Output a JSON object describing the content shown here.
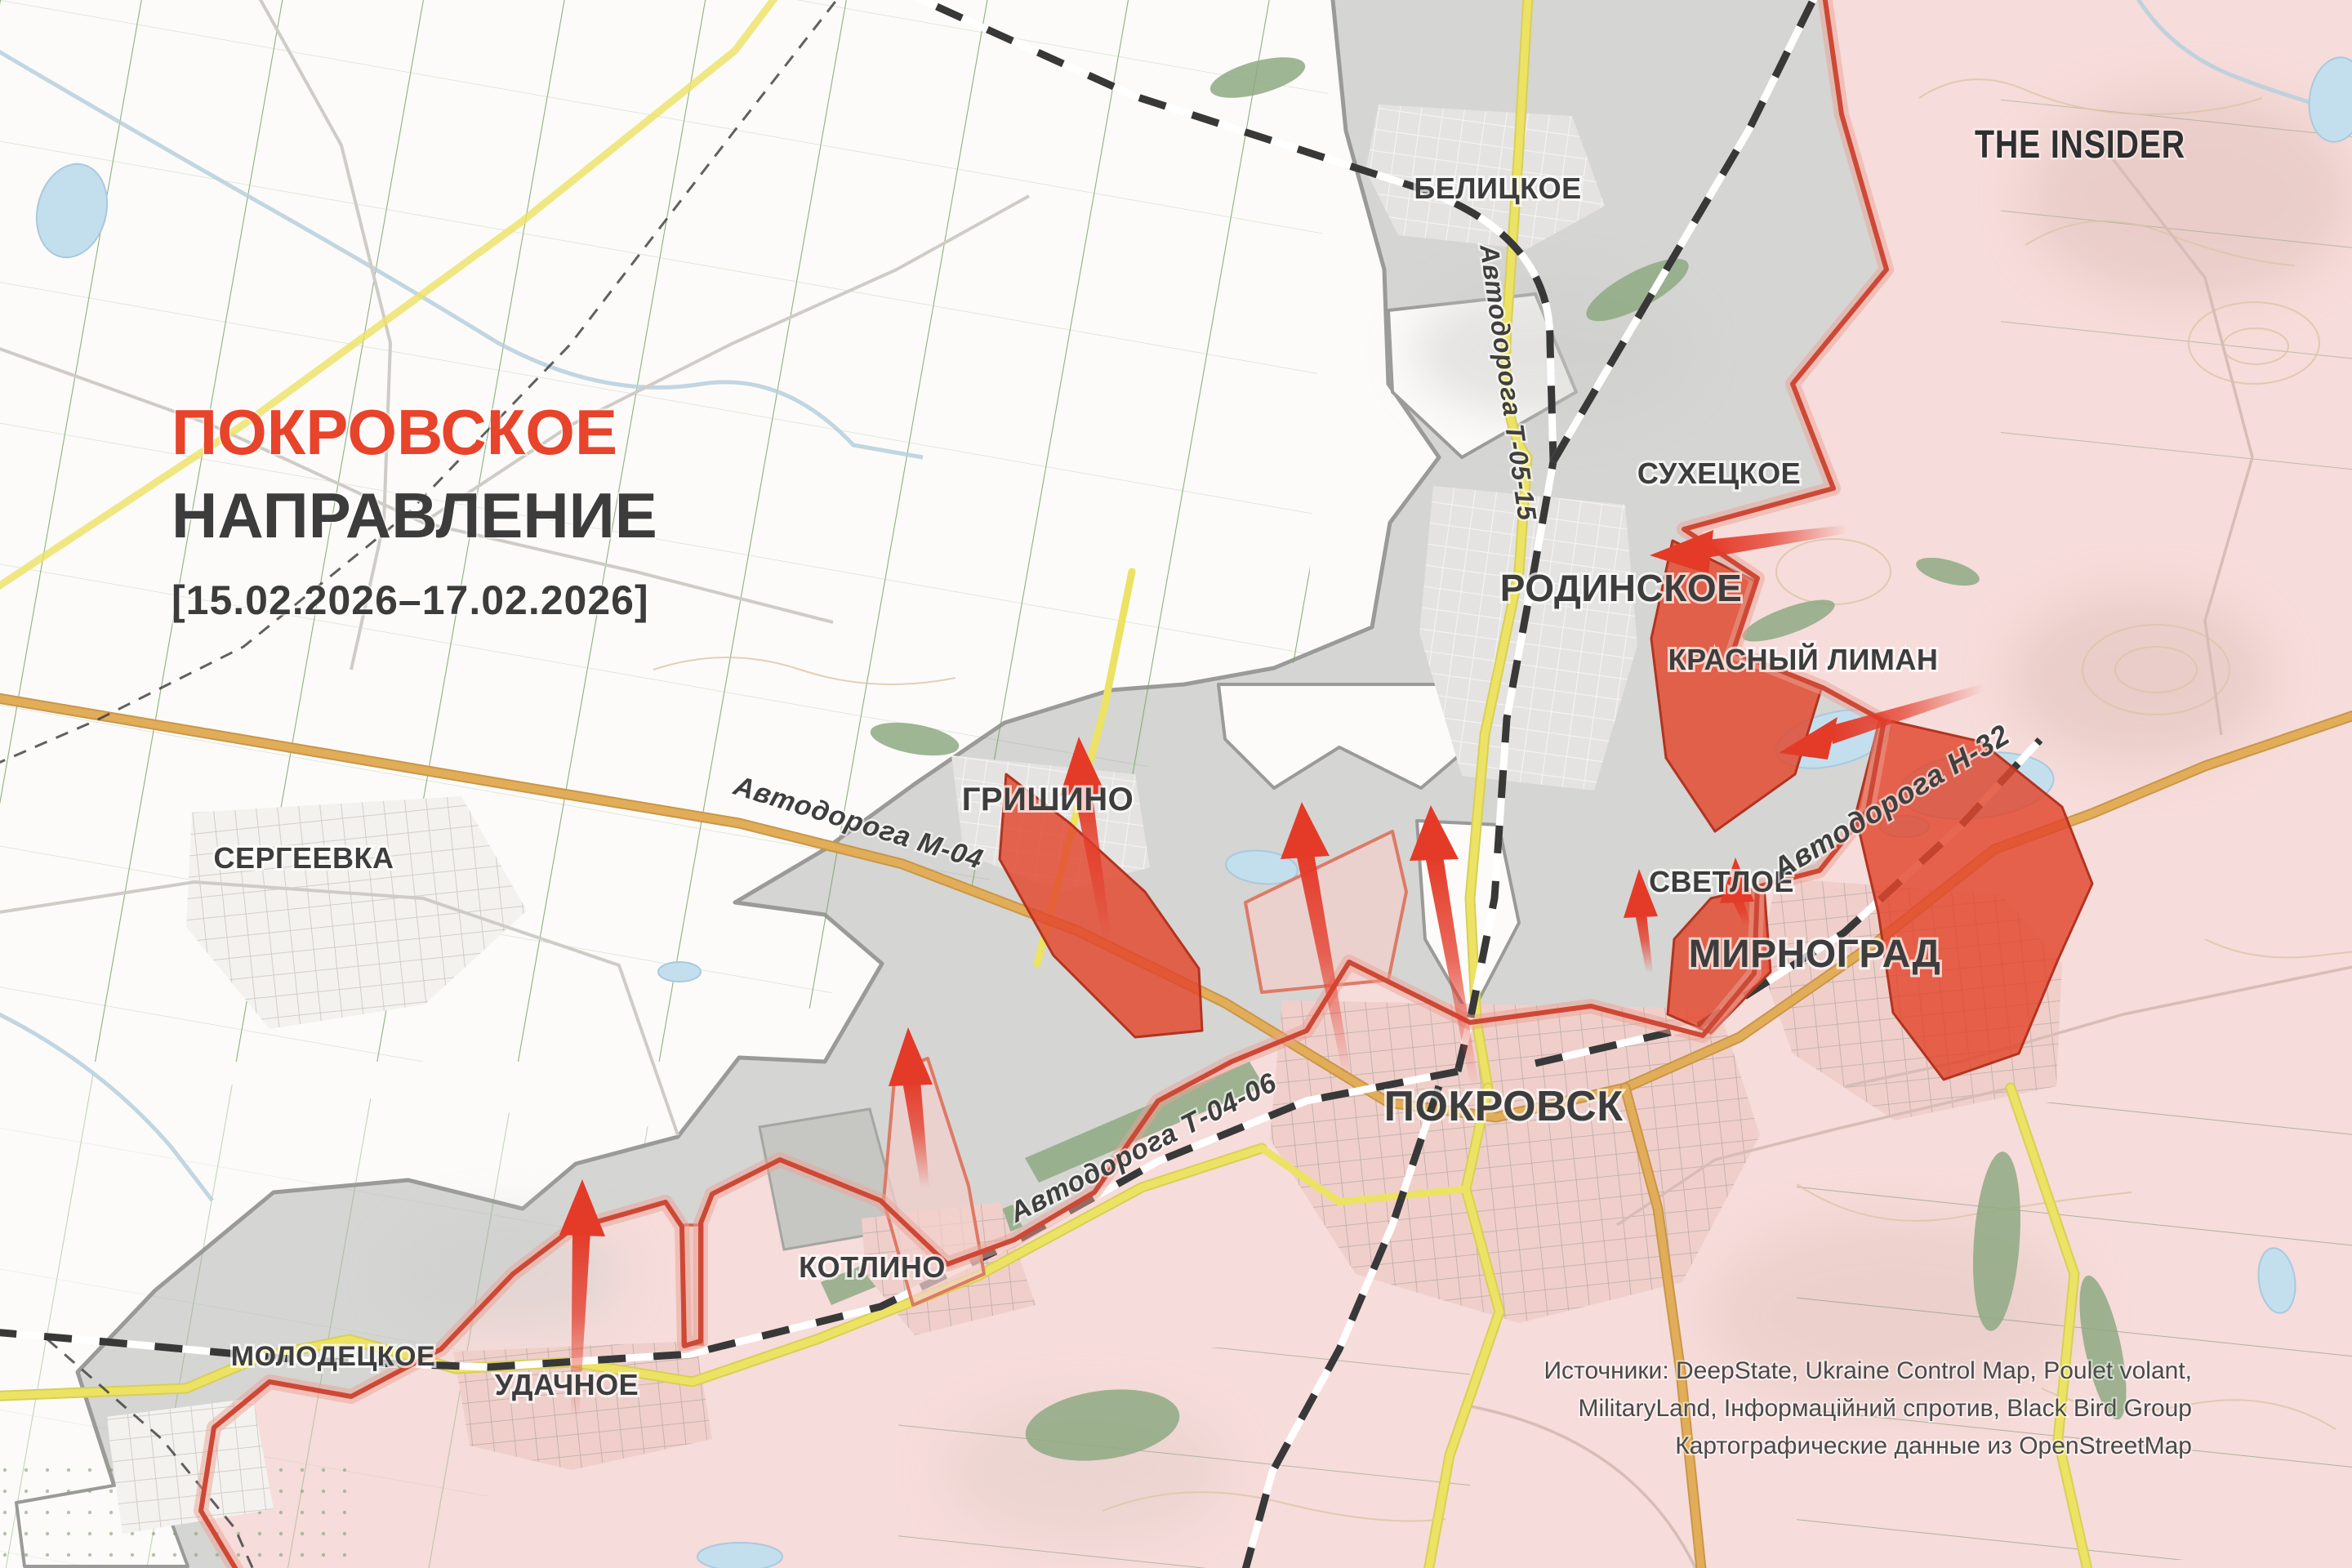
{
  "title": {
    "line1": "ПОКРОВСКОЕ",
    "line2": "НАПРАВЛЕНИЕ",
    "date_range": "[15.02.2026–17.02.2026]"
  },
  "brand": {
    "name": "THE INSIDER"
  },
  "settlements": {
    "belitskoe": "БЕЛИЦКОЕ",
    "sukhetskoe": "СУХЕЦКОЕ",
    "rodinskoe": "РОДИНСКОЕ",
    "krasny_liman": "КРАСНЫЙ ЛИМАН",
    "grishino": "ГРИШИНО",
    "sergeevka": "СЕРГЕЕВКА",
    "svetloe": "СВЕТЛОЕ",
    "mirnograd": "МИРНОГРАД",
    "pokrovsk": "ПОКРОВСК",
    "kotlino": "КОТЛИНО",
    "molodetskoe": "МОЛОДЕЦКОЕ",
    "udachnoe": "УДАЧНОЕ"
  },
  "roads": {
    "t0515": "Автодорога Т-05-15",
    "m04": "Автодорога М-04",
    "h32": "Автодорога Н-32",
    "t0406": "Автодорога Т-04-06"
  },
  "sources": {
    "line1": "Источники: DeepState, Ukraine Control Map, Poulet volant,",
    "line2": "MilitaryLand, Інформаційний спротив, Black Bird Group",
    "line3": "Картографические данные из OpenStreetMap"
  },
  "colors": {
    "title_red": "#e8432b",
    "title_dark": "#3c3c3c",
    "ua_area": "#fcfbf9",
    "contested_gray": "#d5d5d3",
    "contested_border": "#9a9a98",
    "ru_area": "#f6dcda",
    "advance_red": "#e2462c",
    "advance_border": "#b23420",
    "frontline_red": "#ce4836",
    "arrow_red": "#e43a28",
    "road_yellow": "#ece264",
    "road_tan": "#e1ad58",
    "water_blue": "#c3dfee",
    "field_green": "#76a167",
    "forest_green": "#8ea983",
    "railway_black": "#383838",
    "label_dark": "#3d3d3d",
    "source_gray": "#4a4a4a"
  }
}
